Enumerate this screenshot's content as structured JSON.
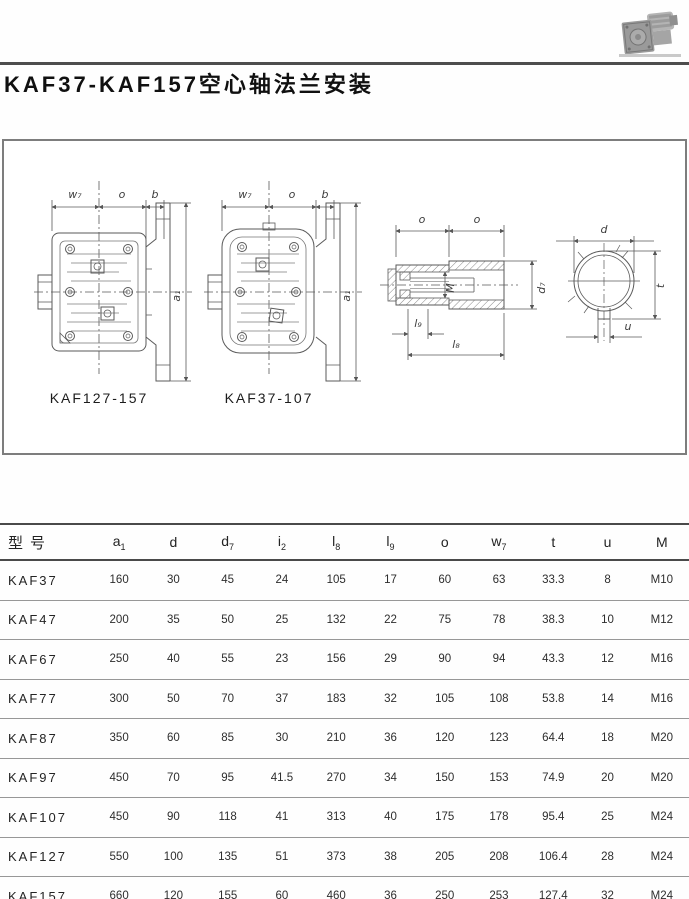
{
  "header": {
    "title": "KAF37-KAF157空心轴法兰安装",
    "photo_icon": "gearmotor-photo"
  },
  "drawings": {
    "variant_left_label": "KAF127-157",
    "variant_right_label": "KAF37-107",
    "dims": {
      "w7": "w₇",
      "o": "o",
      "b": "b",
      "a1": "a₁",
      "M": "M",
      "d7": "d₇",
      "l8": "l₈",
      "l9": "l₉",
      "d": "d",
      "t": "t",
      "u": "u"
    }
  },
  "table": {
    "columns": [
      {
        "label": "型号",
        "sub": ""
      },
      {
        "label": "a",
        "sub": "1"
      },
      {
        "label": "d",
        "sub": ""
      },
      {
        "label": "d",
        "sub": "7"
      },
      {
        "label": "i",
        "sub": "2"
      },
      {
        "label": "l",
        "sub": "8"
      },
      {
        "label": "l",
        "sub": "9"
      },
      {
        "label": "o",
        "sub": ""
      },
      {
        "label": "w",
        "sub": "7"
      },
      {
        "label": "t",
        "sub": ""
      },
      {
        "label": "u",
        "sub": ""
      },
      {
        "label": "M",
        "sub": ""
      }
    ],
    "rows": [
      [
        "KAF37",
        160,
        30,
        45,
        24,
        105,
        17,
        60,
        63,
        33.3,
        8,
        "M10"
      ],
      [
        "KAF47",
        200,
        35,
        50,
        25,
        132,
        22,
        75,
        78,
        38.3,
        10,
        "M12"
      ],
      [
        "KAF67",
        250,
        40,
        55,
        23,
        156,
        29,
        90,
        94,
        43.3,
        12,
        "M16"
      ],
      [
        "KAF77",
        300,
        50,
        70,
        37,
        183,
        32,
        105,
        108,
        53.8,
        14,
        "M16"
      ],
      [
        "KAF87",
        350,
        60,
        85,
        30,
        210,
        36,
        120,
        123,
        64.4,
        18,
        "M20"
      ],
      [
        "KAF97",
        450,
        70,
        95,
        41.5,
        270,
        34,
        150,
        153,
        74.9,
        20,
        "M20"
      ],
      [
        "KAF107",
        450,
        90,
        118,
        41,
        313,
        40,
        175,
        178,
        95.4,
        25,
        "M24"
      ],
      [
        "KAF127",
        550,
        100,
        135,
        51,
        373,
        38,
        205,
        208,
        106.4,
        28,
        "M24"
      ],
      [
        "KAF157",
        660,
        120,
        155,
        60,
        460,
        36,
        250,
        253,
        127.4,
        32,
        "M24"
      ]
    ]
  }
}
